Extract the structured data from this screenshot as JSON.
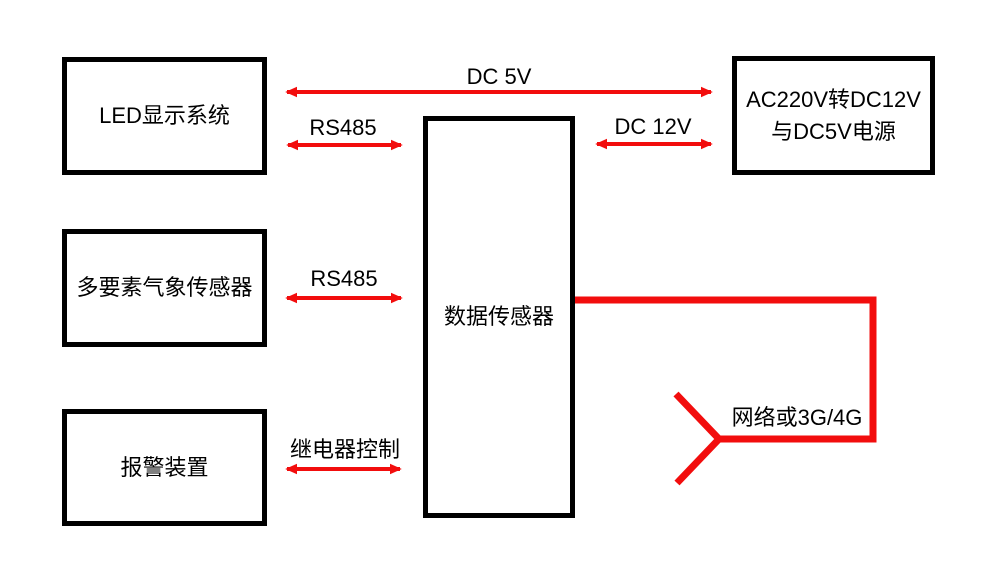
{
  "diagram": {
    "title": "数据传感器系统连接图",
    "type": "block-diagram",
    "background_color": "#ffffff",
    "box_border_color": "#000000",
    "wire_color": "#f20d0d",
    "text_color": "#000000"
  },
  "nodes": {
    "led_display": {
      "label": "LED显示系统"
    },
    "weather_sensor": {
      "label": "多要素气象传感器"
    },
    "alarm_device": {
      "label": "报警装置"
    },
    "data_sensor": {
      "label": "数据传感器"
    },
    "power_supply": {
      "label_line1": "AC220V转DC12V",
      "label_line2": "与DC5V电源"
    }
  },
  "connections": {
    "dc5v": {
      "label": "DC 5V",
      "from": "power_supply",
      "to": "led_display",
      "style": "double-arrow"
    },
    "rs485_top": {
      "label": "RS485",
      "from": "led_display",
      "to": "data_sensor",
      "style": "double-arrow"
    },
    "dc12v": {
      "label": "DC 12V",
      "from": "power_supply",
      "to": "data_sensor",
      "style": "double-arrow"
    },
    "rs485_mid": {
      "label": "RS485",
      "from": "weather_sensor",
      "to": "data_sensor",
      "style": "double-arrow"
    },
    "relay": {
      "label": "继电器控制",
      "from": "data_sensor",
      "to": "alarm_device",
      "style": "double-arrow"
    },
    "network": {
      "label": "网络或3G/4G",
      "from": "data_sensor",
      "to": "antenna",
      "style": "polyline"
    }
  }
}
